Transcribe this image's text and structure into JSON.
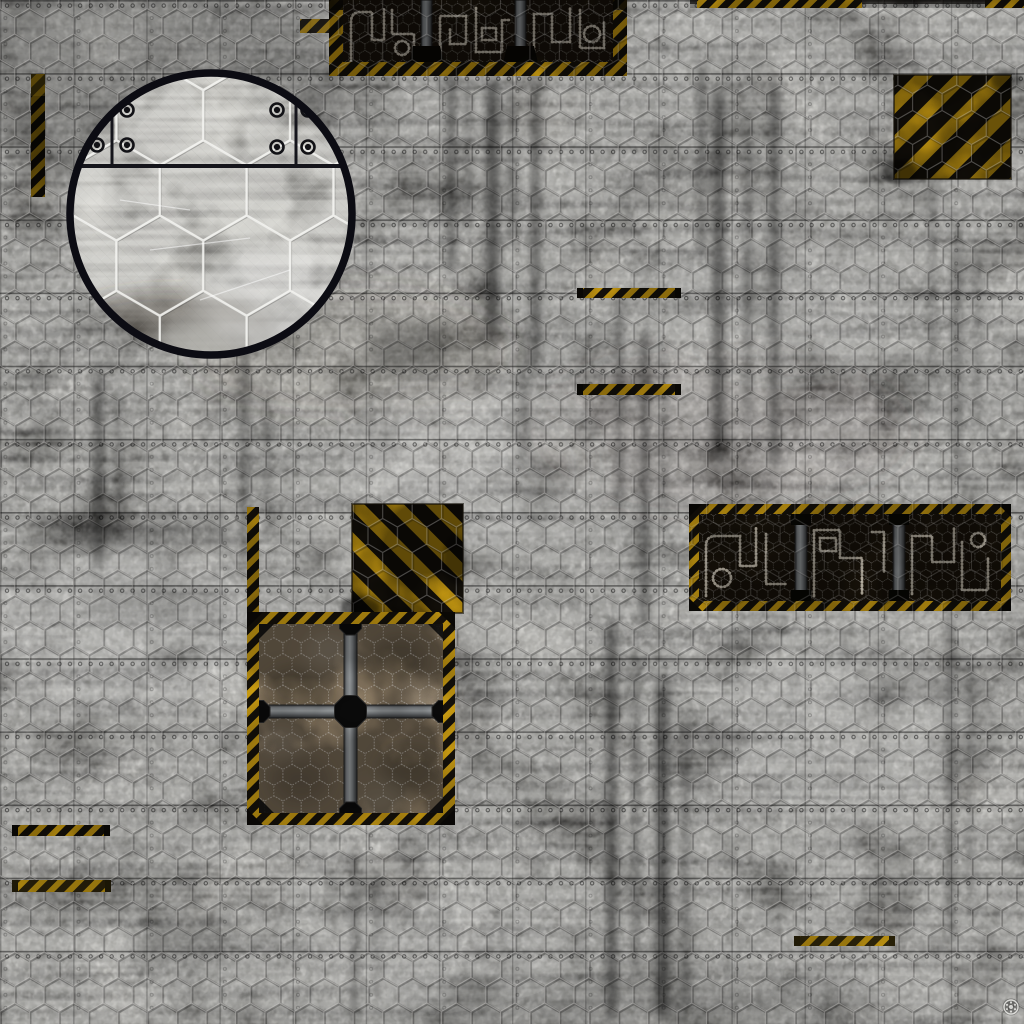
{
  "meta": {
    "kind": "texture-artwork-screenshot",
    "subject": "grimdark sci-fi industrial battle mat, top-down floor texture",
    "surface": "weathered grey concrete/metal plates with square seams, rivet rows and hexagonal wire-mesh embossing"
  },
  "colors": {
    "concrete_base": "#8f8c86",
    "plate_seam": "#181818",
    "mesh_light": "#e8e6e1",
    "hazard_yellow": "#d7a614",
    "hazard_yellow_bright": "#f2c51d",
    "hazard_black": "#17130c",
    "panel_interior": "#1a140b",
    "pipe_glyph": "#ece4d2",
    "metal_bar": "#8d9194",
    "hatch_tile": "#a28f74",
    "detail_ring": "#0c0c13",
    "rivet_dark": "#0d0d0d",
    "logo_light": "#e6e6e2"
  },
  "scene": {
    "elements": [
      {
        "name": "floor-base",
        "desc": "mottled grey concrete ground with grime streaks and scratches",
        "bbox": [
          0,
          0,
          1024,
          1024
        ]
      },
      {
        "name": "floor-plates-grid",
        "desc": "square plate seams with rivet rows, ~73px cells",
        "bbox": [
          0,
          0,
          1024,
          1024
        ]
      },
      {
        "name": "floor-hex-mesh",
        "desc": "faint chicken-wire hexagon mesh over entire floor, ~29px hexes",
        "bbox": [
          0,
          0,
          1024,
          1024
        ]
      },
      {
        "name": "top-conduit-panel",
        "desc": "dark pipe-grate panel with hazard striped frame, cropped by top edge",
        "bbox": [
          329,
          0,
          298,
          76
        ]
      },
      {
        "name": "top-left-hazard-nub",
        "desc": "small faded hazard tab left of top conduit panel",
        "bbox": [
          300,
          19,
          30,
          14
        ]
      },
      {
        "name": "top-edge-hazard-strip-1",
        "desc": "thin hazard sliver on top edge",
        "bbox": [
          697,
          0,
          165,
          8
        ]
      },
      {
        "name": "top-edge-hazard-strip-2",
        "desc": "thin hazard sliver at top right corner",
        "bbox": [
          985,
          0,
          39,
          8
        ]
      },
      {
        "name": "top-right-hazard-square",
        "desc": "yellow/black diagonal hazard square, stripes rising to the right",
        "bbox": [
          894,
          75,
          117,
          104
        ]
      },
      {
        "name": "left-hazard-strip",
        "desc": "faded vertical hazard strip near left edge",
        "bbox": [
          31,
          74,
          14,
          123
        ]
      },
      {
        "name": "zoom-detail-circle",
        "desc": "magnifier callout circle showing enlarged hex grid, plate seams and rivets",
        "center": [
          211,
          214
        ],
        "radius": 145
      },
      {
        "name": "hazard-strip-center-upper",
        "desc": "short horizontal hazard strip",
        "bbox": [
          577,
          288,
          104,
          10
        ]
      },
      {
        "name": "hazard-strip-center-lower",
        "desc": "short horizontal hazard strip",
        "bbox": [
          577,
          384,
          104,
          11
        ]
      },
      {
        "name": "center-hazard-square",
        "desc": "yellow/black diagonal hazard square, stripes falling to the right",
        "bbox": [
          352,
          504,
          111,
          109
        ]
      },
      {
        "name": "hatch-left-hazard-border",
        "desc": "vertical hazard border above cargo hatch left edge",
        "bbox": [
          247,
          507,
          12,
          105
        ]
      },
      {
        "name": "cargo-hatch-panel",
        "desc": "large hatch with hazard frame, grey cross bars, black octagon hubs and four meshed tan tiles",
        "bbox": [
          247,
          612,
          208,
          213
        ]
      },
      {
        "name": "right-conduit-panel",
        "desc": "wide dark pipe-grate panel with hazard frame and two divider bars",
        "bbox": [
          689,
          504,
          322,
          107
        ]
      },
      {
        "name": "bottom-left-hazard-strip-1",
        "desc": "short horizontal hazard strip",
        "bbox": [
          12,
          825,
          98,
          11
        ]
      },
      {
        "name": "bottom-left-hazard-strip-2",
        "desc": "short horizontal hazard strip",
        "bbox": [
          12,
          880,
          99,
          12
        ]
      },
      {
        "name": "bottom-right-hazard-strip",
        "desc": "short horizontal hazard strip",
        "bbox": [
          794,
          936,
          101,
          10
        ]
      },
      {
        "name": "maker-logo-mark",
        "desc": "tiny light circular rosette maker's mark",
        "center": [
          1011,
          1007
        ],
        "radius": 8
      }
    ]
  }
}
